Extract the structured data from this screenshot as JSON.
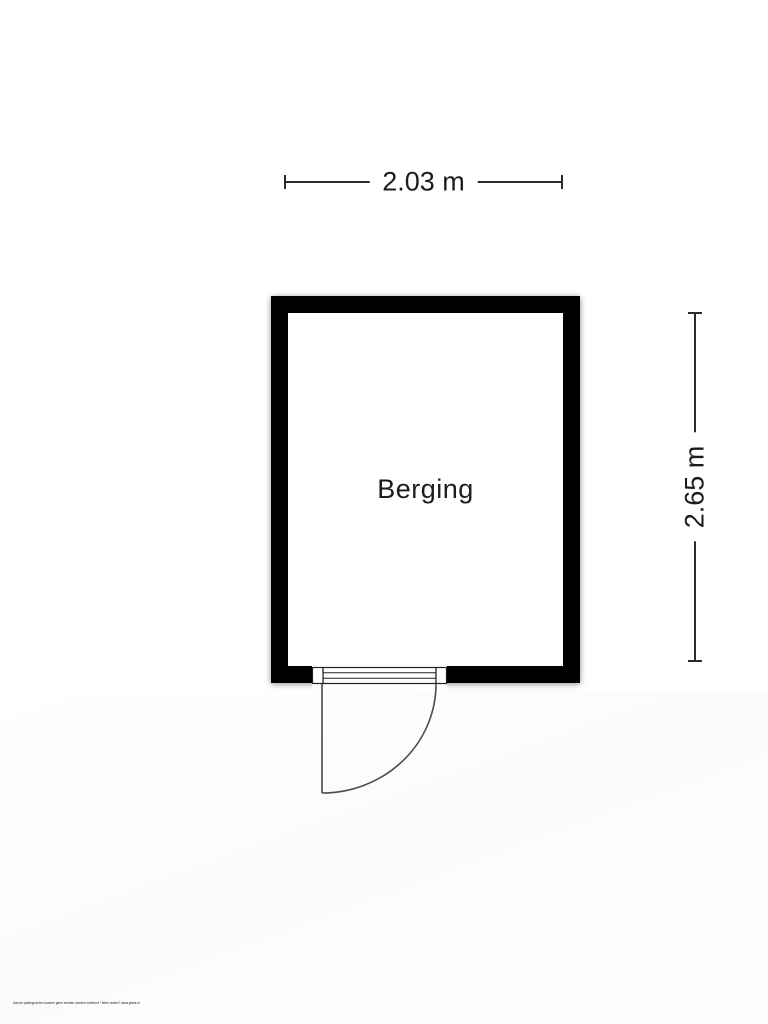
{
  "floor_plan": {
    "room": {
      "name": "Berging"
    },
    "dimensions": {
      "width_label": "2.03 m",
      "height_label": "2.65 m"
    },
    "door": {
      "type": "single-swing-door",
      "wall": "bottom",
      "hinge": "left",
      "swing": "outward"
    },
    "colors": {
      "wall": "#000000",
      "dimension_line": "#2b2b2b",
      "door_line": "#4a4a4a",
      "background": "#ffffff"
    }
  },
  "footer": {
    "disclaimer": "Aan de plattegronden kunnen geen rechten worden ontleend * Meer weten? www.plans.nl"
  }
}
